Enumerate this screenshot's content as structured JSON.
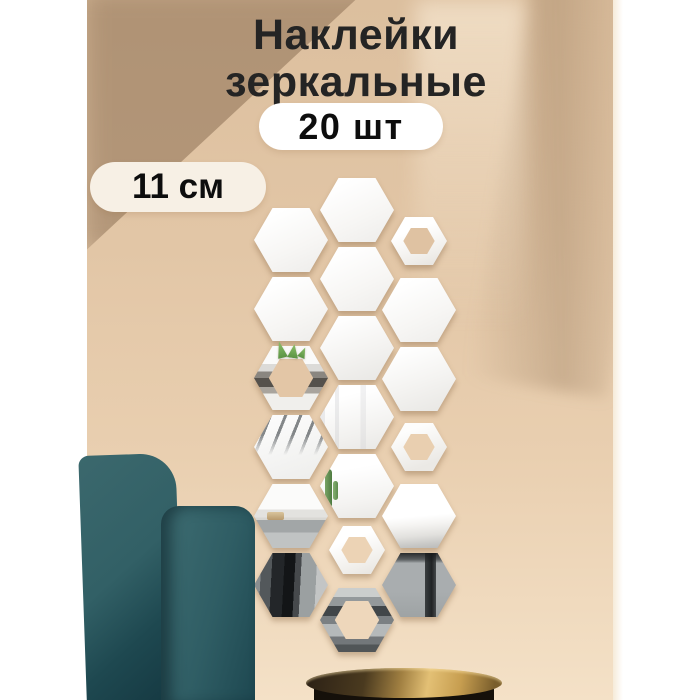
{
  "title": {
    "line1": "Наклейки",
    "line2": "зеркальные"
  },
  "badges": {
    "count": "20 шт",
    "size": "11 см"
  },
  "colors": {
    "wall": "#e2c6a6",
    "wall_shadow": "#7a5e42",
    "side_band": "#ffffff",
    "pill_cream": "#f7f0e5",
    "pill_white": "#ffffff",
    "text_dark": "#242424",
    "chair_teal": "#2f5d64",
    "lamp_gold": "#e3c075",
    "mirror_white": "#fafaf9"
  },
  "hexagons": {
    "sizes": {
      "big": {
        "w": 74,
        "h": 64
      },
      "small": {
        "w": 56,
        "h": 48
      }
    },
    "ring_inset": {
      "big": "20%",
      "small": "22%"
    },
    "items": [
      {
        "cx": 291,
        "cy": 240,
        "size": "big",
        "kind": "mirror",
        "variant": "plain"
      },
      {
        "cx": 291,
        "cy": 309,
        "size": "big",
        "kind": "mirror",
        "variant": "plain"
      },
      {
        "cx": 291,
        "cy": 378,
        "size": "big",
        "kind": "ring",
        "variant": "ringshelf",
        "hole": "#e3c6a6"
      },
      {
        "cx": 291,
        "cy": 447,
        "size": "big",
        "kind": "mirror",
        "variant": "blinds"
      },
      {
        "cx": 291,
        "cy": 516,
        "size": "big",
        "kind": "mirror",
        "variant": "floor"
      },
      {
        "cx": 291,
        "cy": 585,
        "size": "big",
        "kind": "mirror",
        "variant": "door"
      },
      {
        "cx": 357,
        "cy": 210,
        "size": "big",
        "kind": "mirror",
        "variant": "plain"
      },
      {
        "cx": 357,
        "cy": 279,
        "size": "big",
        "kind": "mirror",
        "variant": "plain"
      },
      {
        "cx": 357,
        "cy": 348,
        "size": "big",
        "kind": "mirror",
        "variant": "plain2"
      },
      {
        "cx": 357,
        "cy": 417,
        "size": "big",
        "kind": "mirror",
        "variant": "curtain"
      },
      {
        "cx": 357,
        "cy": 486,
        "size": "big",
        "kind": "mirror",
        "variant": "cactus"
      },
      {
        "cx": 357,
        "cy": 550,
        "size": "small",
        "kind": "ring",
        "variant": "ringplain",
        "hole": "#ecd3b5"
      },
      {
        "cx": 357,
        "cy": 620,
        "size": "big",
        "kind": "ring",
        "variant": "ringfloor",
        "hole": "#eed7bb"
      },
      {
        "cx": 419,
        "cy": 241,
        "size": "small",
        "kind": "ring",
        "variant": "ringplain",
        "hole": "#dfc2a2"
      },
      {
        "cx": 419,
        "cy": 310,
        "size": "big",
        "kind": "mirror",
        "variant": "plain"
      },
      {
        "cx": 419,
        "cy": 379,
        "size": "big",
        "kind": "mirror",
        "variant": "plain2"
      },
      {
        "cx": 419,
        "cy": 447,
        "size": "small",
        "kind": "ring",
        "variant": "ringplain2",
        "hole": "#e9cfb0"
      },
      {
        "cx": 419,
        "cy": 516,
        "size": "big",
        "kind": "mirror",
        "variant": "bed"
      },
      {
        "cx": 419,
        "cy": 585,
        "size": "big",
        "kind": "mirror",
        "variant": "floorleg"
      }
    ]
  }
}
